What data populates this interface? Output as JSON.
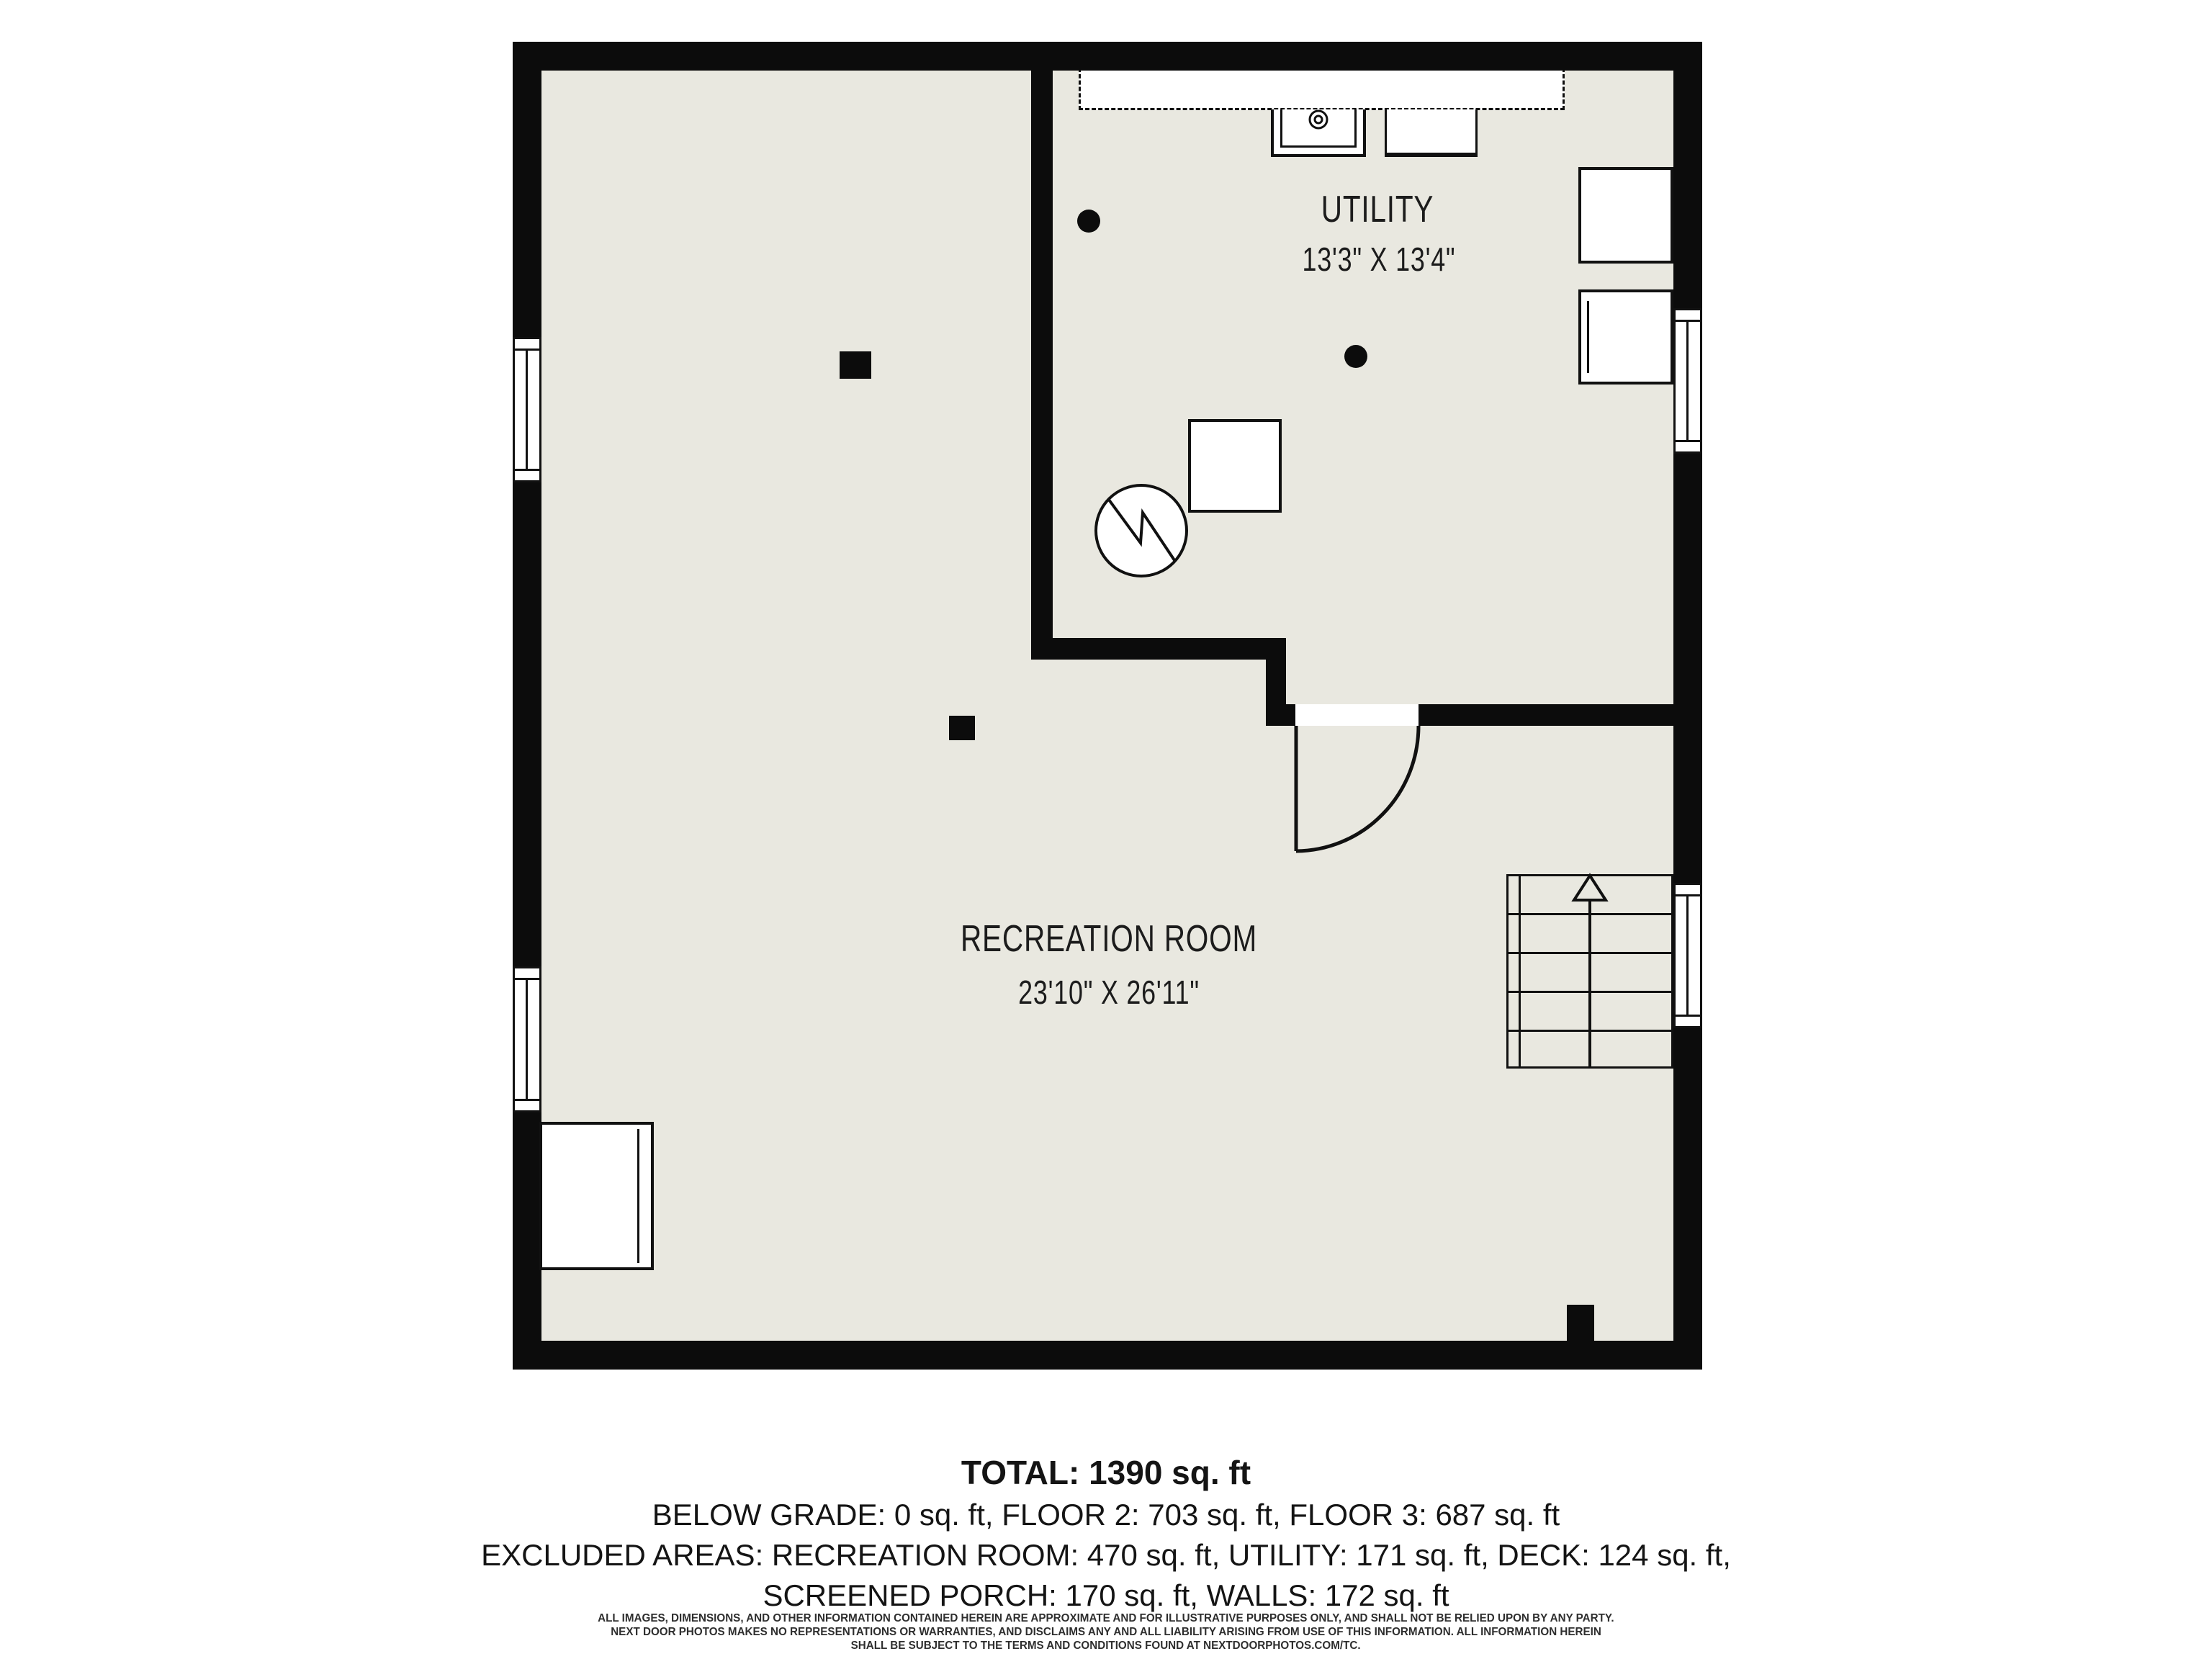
{
  "plan": {
    "colors": {
      "floor": "#e9e8e0",
      "wall": "#0c0c0c",
      "paper": "#ffffff",
      "line": "#111111"
    },
    "rooms": [
      {
        "name": "UTILITY",
        "dims": "13'3\" X 13'4\""
      },
      {
        "name": "RECREATION ROOM",
        "dims": "23'10\" X 26'11\""
      }
    ]
  },
  "summary": {
    "total": "TOTAL: 1390 sq. ft",
    "line2": "BELOW GRADE: 0 sq. ft, FLOOR 2: 703 sq. ft, FLOOR 3: 687 sq. ft",
    "line3": "EXCLUDED AREAS: RECREATION ROOM: 470 sq. ft, UTILITY: 171 sq. ft, DECK: 124 sq. ft,",
    "line4": "SCREENED PORCH: 170 sq. ft, WALLS: 172 sq. ft"
  },
  "disclaimer": {
    "line1": "ALL IMAGES, DIMENSIONS, AND OTHER INFORMATION CONTAINED HEREIN ARE APPROXIMATE AND FOR ILLUSTRATIVE PURPOSES ONLY, AND SHALL NOT BE RELIED UPON BY ANY PARTY.",
    "line2": "NEXT DOOR PHOTOS MAKES NO REPRESENTATIONS OR WARRANTIES, AND DISCLAIMS ANY AND ALL LIABILITY ARISING FROM USE OF THIS INFORMATION. ALL INFORMATION HEREIN",
    "line3": "SHALL BE SUBJECT TO THE TERMS AND CONDITIONS FOUND AT NEXTDOORPHOTOS.COM/TC."
  }
}
